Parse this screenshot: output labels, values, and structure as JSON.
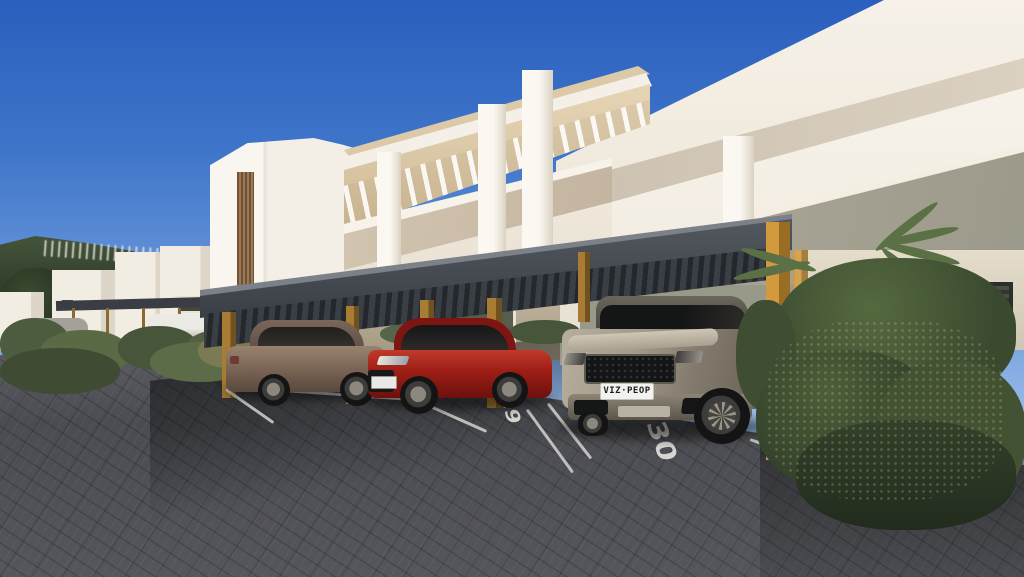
{
  "scene": {
    "suv": {
      "license_plate": "VIZ·PEOP"
    },
    "parking_spaces": [
      {
        "number": "29"
      },
      {
        "number": "30"
      }
    ],
    "colors": {
      "sky_top": "#2a5fbe",
      "hill_green": "#2e3b2a",
      "band_grey": "#b2ab9c",
      "canopy_beige": "#cdb893",
      "parapet_beige": "#d3c6b1",
      "carport_grey": "#33373d",
      "wood_gold": "#d29a3d",
      "car_bronze": "#7d6757",
      "car_red": "#a02017",
      "car_silver": "#b7ae9e"
    }
  }
}
